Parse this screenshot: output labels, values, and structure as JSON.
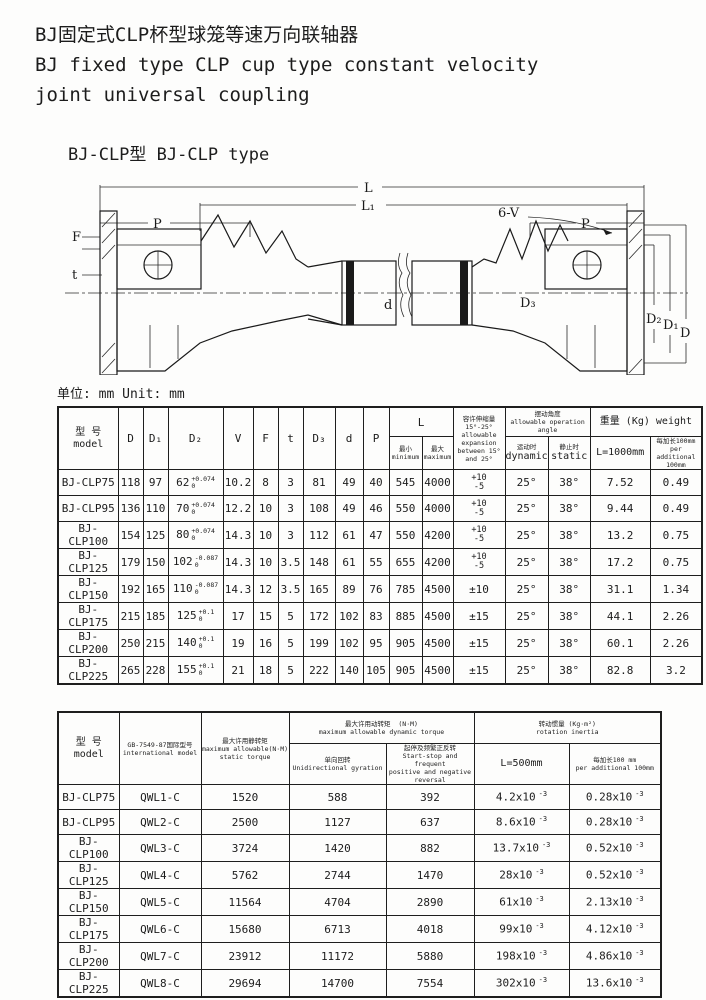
{
  "page": {
    "title_zh": "BJ固定式CLP杯型球笼等速万向联轴器",
    "title_en_line1": "BJ fixed type CLP cup type constant velocity",
    "title_en_line2": "joint universal coupling",
    "subtitle": "BJ-CLP型 BJ-CLP type",
    "unit_note": "单位: mm Unit: mm"
  },
  "drawing": {
    "labels": {
      "L": "L",
      "L1": "L₁",
      "P_left": "P",
      "P_right": "P",
      "F": "F",
      "t": "t",
      "sixV": "6-V",
      "d": "d",
      "D3": "D₃",
      "D2": "D₂",
      "D1": "D₁",
      "D": "D"
    }
  },
  "table1": {
    "headers": {
      "model_zh": "型 号",
      "model_en": "model",
      "D": "D",
      "D1": "D₁",
      "D2": "D₂",
      "V": "V",
      "F": "F",
      "t": "t",
      "D3": "D₃",
      "d": "d",
      "P": "P",
      "L": "L",
      "L_min_zh": "最小",
      "L_min_en": "minimum",
      "L_max_zh": "最大",
      "L_max_en": "maximum",
      "expansion_zh": "容许伸缩量15°-25°",
      "expansion_en1": "allowable expansion",
      "expansion_en2": "between 15° and 25°",
      "angle_zh": "摆动角度",
      "angle_en": "allowable operation angle",
      "dynamic_zh": "运动时",
      "dynamic_en": "dynamic",
      "static_zh": "静止时",
      "static_en": "static",
      "weight": "重量 (Kg) weight",
      "w1000": "L=1000mm",
      "wadd_zh": "每加长100mm",
      "wadd_en": "per additional 100mm"
    },
    "rows": [
      {
        "model": "BJ-CLP75",
        "D": "118",
        "D1": "97",
        "D2": "62",
        "D2t": "+0.074",
        "D2b": "0",
        "V": "10.2",
        "F": "8",
        "t": "3",
        "D3": "81",
        "d": "49",
        "P": "40",
        "Lmin": "545",
        "Lmax": "4000",
        "expT": "+10",
        "expB": "-5",
        "dyn": "25°",
        "stat": "38°",
        "w1000": "7.52",
        "wadd": "0.49"
      },
      {
        "model": "BJ-CLP95",
        "D": "136",
        "D1": "110",
        "D2": "70",
        "D2t": "+0.074",
        "D2b": "0",
        "V": "12.2",
        "F": "10",
        "t": "3",
        "D3": "108",
        "d": "49",
        "P": "46",
        "Lmin": "550",
        "Lmax": "4000",
        "expT": "+10",
        "expB": "-5",
        "dyn": "25°",
        "stat": "38°",
        "w1000": "9.44",
        "wadd": "0.49"
      },
      {
        "model": "BJ-CLP100",
        "D": "154",
        "D1": "125",
        "D2": "80",
        "D2t": "+0.074",
        "D2b": "0",
        "V": "14.3",
        "F": "10",
        "t": "3",
        "D3": "112",
        "d": "61",
        "P": "47",
        "Lmin": "550",
        "Lmax": "4200",
        "expT": "+10",
        "expB": "-5",
        "dyn": "25°",
        "stat": "38°",
        "w1000": "13.2",
        "wadd": "0.75"
      },
      {
        "model": "BJ-CLP125",
        "D": "179",
        "D1": "150",
        "D2": "102",
        "D2t": "-0.087",
        "D2b": "0",
        "V": "14.3",
        "F": "10",
        "t": "3.5",
        "D3": "148",
        "d": "61",
        "P": "55",
        "Lmin": "655",
        "Lmax": "4200",
        "expT": "+10",
        "expB": "-5",
        "dyn": "25°",
        "stat": "38°",
        "w1000": "17.2",
        "wadd": "0.75"
      },
      {
        "model": "BJ-CLP150",
        "D": "192",
        "D1": "165",
        "D2": "110",
        "D2t": "-0.087",
        "D2b": "0",
        "V": "14.3",
        "F": "12",
        "t": "3.5",
        "D3": "165",
        "d": "89",
        "P": "76",
        "Lmin": "785",
        "Lmax": "4500",
        "expT": "±10",
        "expB": "",
        "dyn": "25°",
        "stat": "38°",
        "w1000": "31.1",
        "wadd": "1.34"
      },
      {
        "model": "BJ-CLP175",
        "D": "215",
        "D1": "185",
        "D2": "125",
        "D2t": "+0.1",
        "D2b": "0",
        "V": "17",
        "F": "15",
        "t": "5",
        "D3": "172",
        "d": "102",
        "P": "83",
        "Lmin": "885",
        "Lmax": "4500",
        "expT": "±15",
        "expB": "",
        "dyn": "25°",
        "stat": "38°",
        "w1000": "44.1",
        "wadd": "2.26"
      },
      {
        "model": "BJ-CLP200",
        "D": "250",
        "D1": "215",
        "D2": "140",
        "D2t": "+0.1",
        "D2b": "0",
        "V": "19",
        "F": "16",
        "t": "5",
        "D3": "199",
        "d": "102",
        "P": "95",
        "Lmin": "905",
        "Lmax": "4500",
        "expT": "±15",
        "expB": "",
        "dyn": "25°",
        "stat": "38°",
        "w1000": "60.1",
        "wadd": "2.26"
      },
      {
        "model": "BJ-CLP225",
        "D": "265",
        "D1": "228",
        "D2": "155",
        "D2t": "+0.1",
        "D2b": "0",
        "V": "21",
        "F": "18",
        "t": "5",
        "D3": "222",
        "d": "140",
        "P": "105",
        "Lmin": "905",
        "Lmax": "4500",
        "expT": "±15",
        "expB": "",
        "dyn": "25°",
        "stat": "38°",
        "w1000": "82.8",
        "wadd": "3.2"
      }
    ]
  },
  "table2": {
    "headers": {
      "model_zh": "型 号",
      "model_en": "model",
      "intl_zh": "GB-7549-87国际型号",
      "intl_en": "international model",
      "static_zh": "最大许用静转矩",
      "static_en1": "maximum allowable(N·M)",
      "static_en2": "static torque",
      "dyn_zh": "最大许用动转矩",
      "dyn_unit": "(N·M)",
      "dyn_en": "maximum allowable dynamic torque",
      "uni_zh": "单向回转",
      "uni_en": "Unidirectional gyration",
      "ss_zh": "起停及频繁正反转",
      "ss_en1": "Start-stop and frequent",
      "ss_en2": "positive and negative reversal",
      "inertia_zh": "转动惯量 (Kg·m²)",
      "inertia_en": "rotation inertia",
      "L500": "L=500mm",
      "add_zh": "每加长100 mm",
      "add_en": "per additional 100mm"
    },
    "rows": [
      {
        "model": "BJ-CLP75",
        "intl": "QWL1-C",
        "st": "1520",
        "uni": "588",
        "ss": "392",
        "i500": "4.2x10",
        "i500e": "-3",
        "iadd": "0.28x10",
        "iadde": "-3"
      },
      {
        "model": "BJ-CLP95",
        "intl": "QWL2-C",
        "st": "2500",
        "uni": "1127",
        "ss": "637",
        "i500": "8.6x10",
        "i500e": "-3",
        "iadd": "0.28x10",
        "iadde": "-3"
      },
      {
        "model": "BJ-CLP100",
        "intl": "QWL3-C",
        "st": "3724",
        "uni": "1420",
        "ss": "882",
        "i500": "13.7x10",
        "i500e": "-3",
        "iadd": "0.52x10",
        "iadde": "-3"
      },
      {
        "model": "BJ-CLP125",
        "intl": "QWL4-C",
        "st": "5762",
        "uni": "2744",
        "ss": "1470",
        "i500": "28x10",
        "i500e": "-3",
        "iadd": "0.52x10",
        "iadde": "-3"
      },
      {
        "model": "BJ-CLP150",
        "intl": "QWL5-C",
        "st": "11564",
        "uni": "4704",
        "ss": "2890",
        "i500": "61x10",
        "i500e": "-3",
        "iadd": "2.13x10",
        "iadde": "-3"
      },
      {
        "model": "BJ-CLP175",
        "intl": "QWL6-C",
        "st": "15680",
        "uni": "6713",
        "ss": "4018",
        "i500": "99x10",
        "i500e": "-3",
        "iadd": "4.12x10",
        "iadde": "-3"
      },
      {
        "model": "BJ-CLP200",
        "intl": "QWL7-C",
        "st": "23912",
        "uni": "11172",
        "ss": "5880",
        "i500": "198x10",
        "i500e": "-3",
        "iadd": "4.86x10",
        "iadde": "-3"
      },
      {
        "model": "BJ-CLP225",
        "intl": "QWL8-C",
        "st": "29694",
        "uni": "14700",
        "ss": "7554",
        "i500": "302x10",
        "i500e": "-3",
        "iadd": "13.6x10",
        "iadde": "-3"
      }
    ]
  }
}
